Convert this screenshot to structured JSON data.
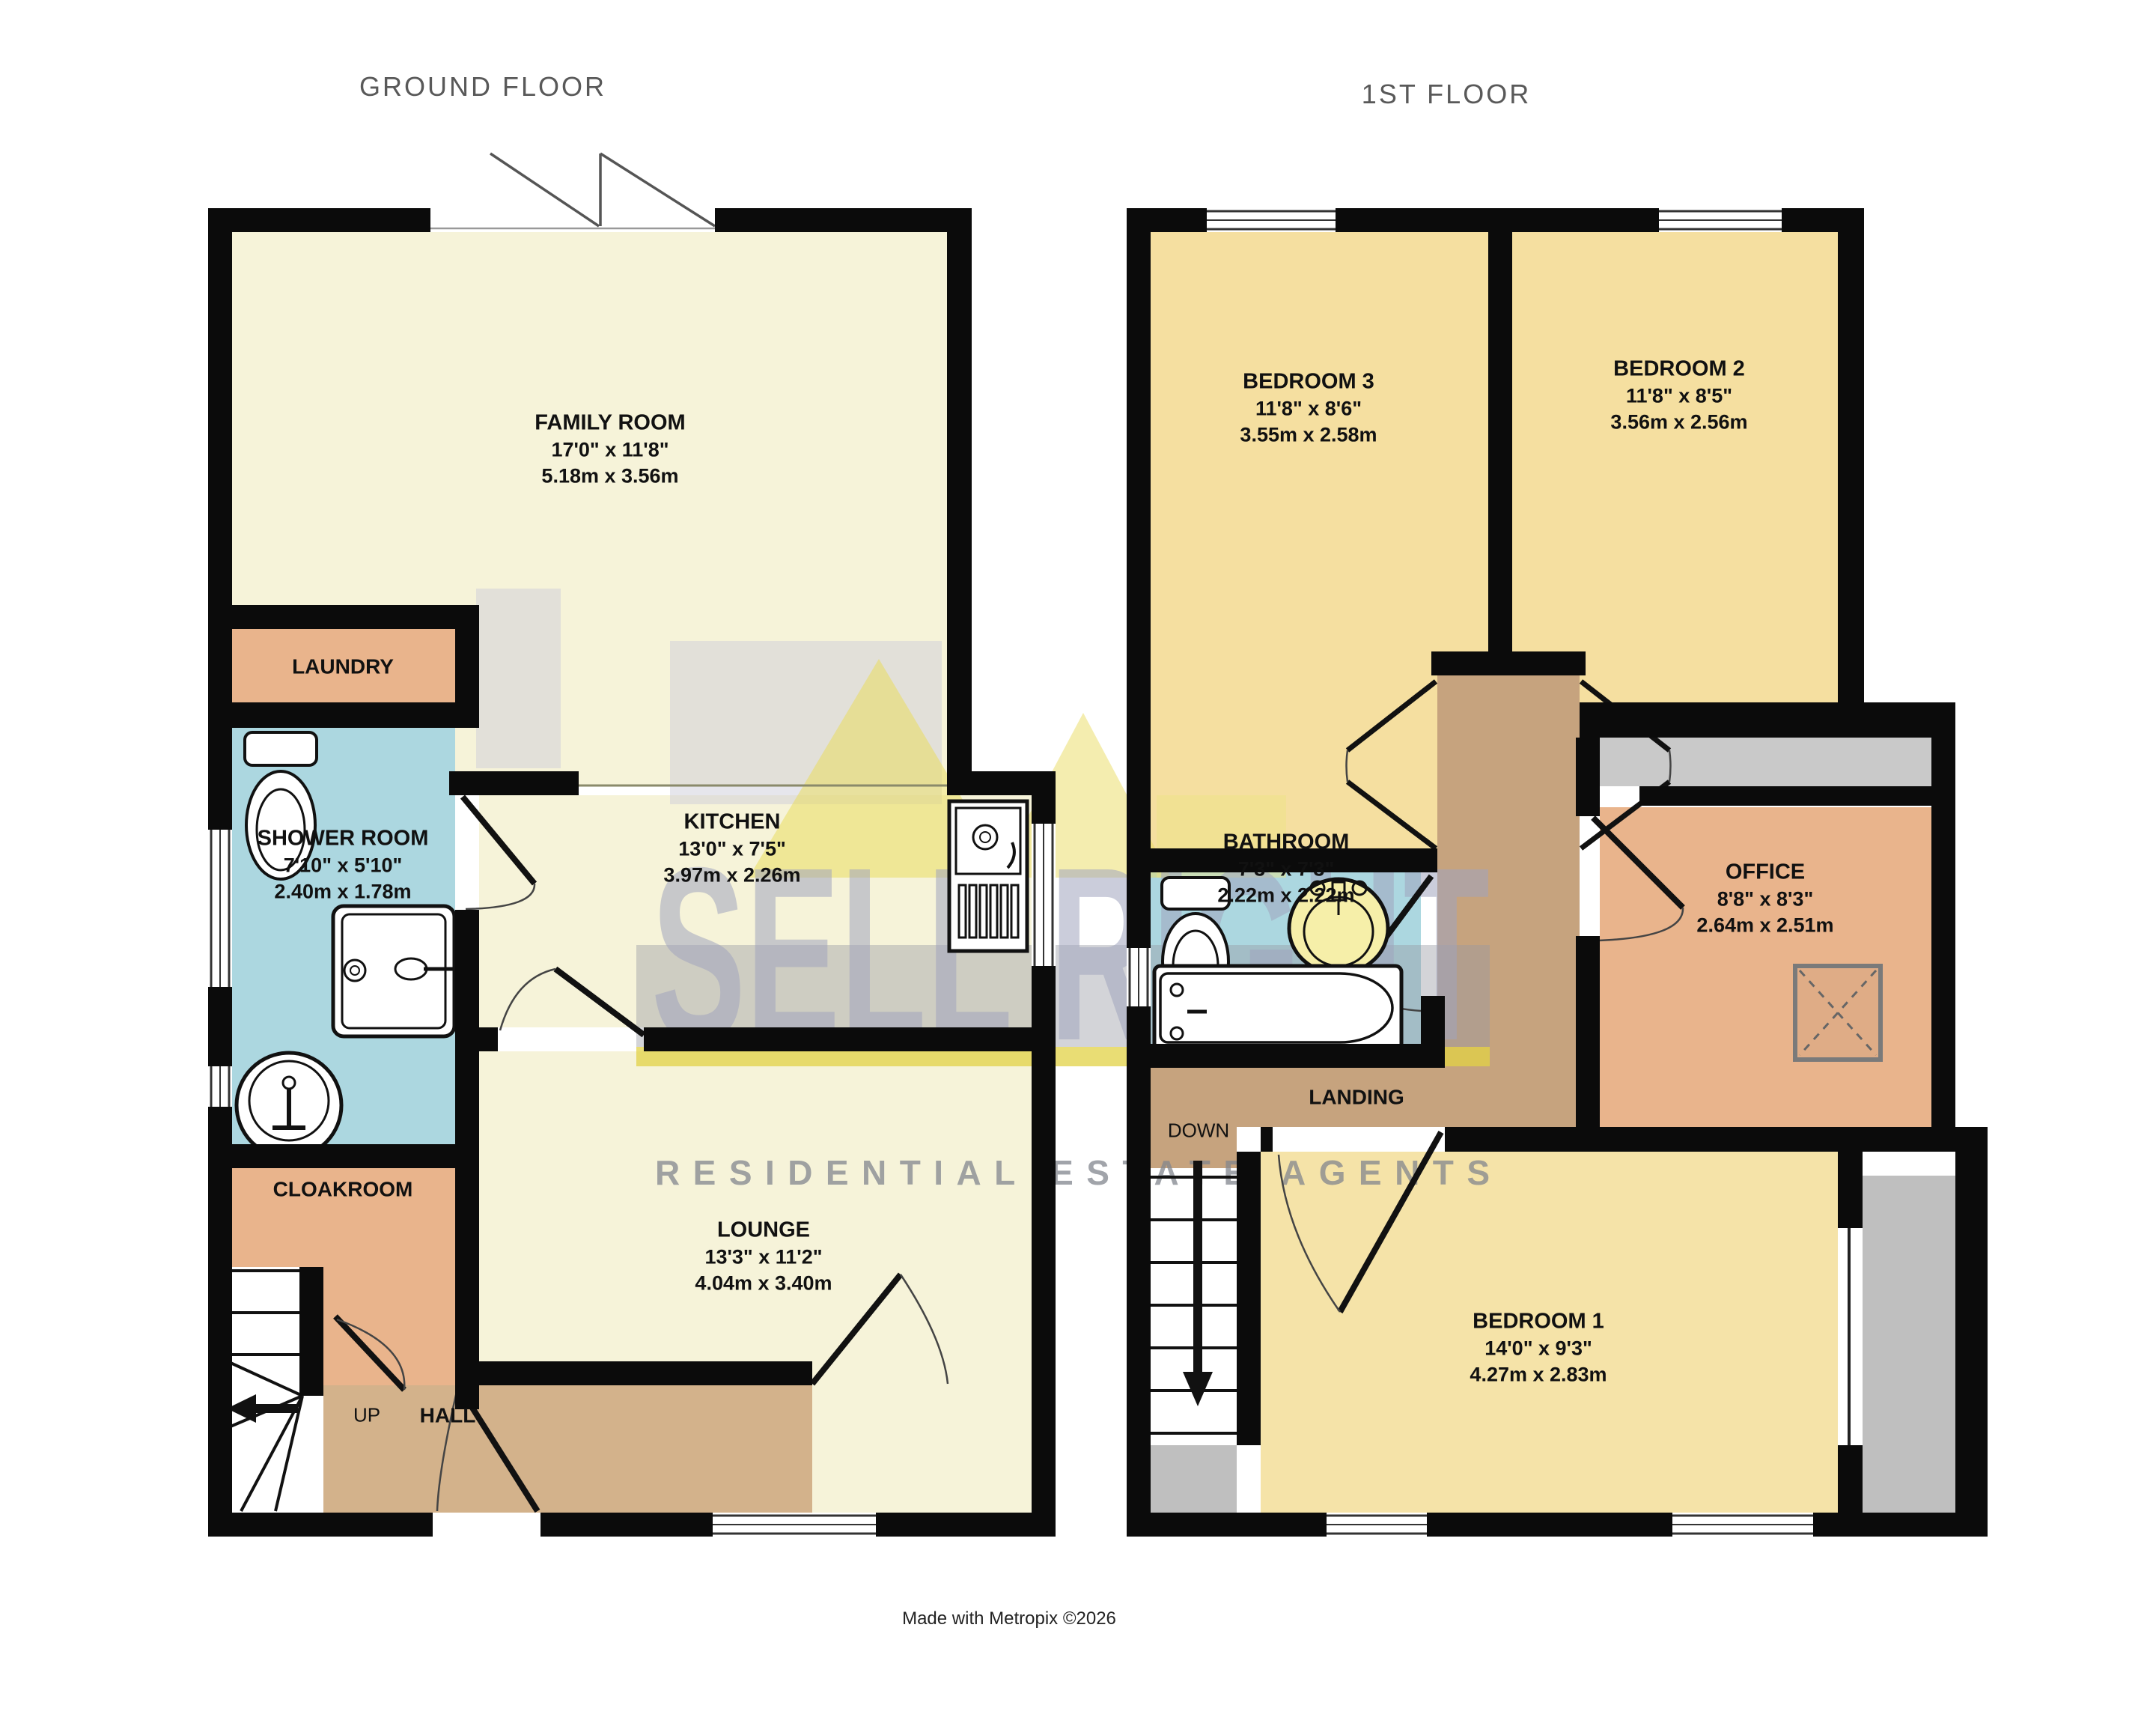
{
  "titles": {
    "ground": "GROUND FLOOR",
    "first": "1ST FLOOR"
  },
  "rooms": {
    "family_room": {
      "name": "FAMILY ROOM",
      "imperial": "17'0\"  x 11'8\"",
      "metric": "5.18m  x 3.56m"
    },
    "laundry": {
      "name": "LAUNDRY"
    },
    "shower_room": {
      "name": "SHOWER ROOM",
      "imperial": "7'10\"  x 5'10\"",
      "metric": "2.40m  x 1.78m"
    },
    "cloakroom": {
      "name": "CLOAKROOM"
    },
    "kitchen": {
      "name": "KITCHEN",
      "imperial": "13'0\"  x 7'5\"",
      "metric": "3.97m  x 2.26m"
    },
    "lounge": {
      "name": "LOUNGE",
      "imperial": "13'3\"  x 11'2\"",
      "metric": "4.04m  x 3.40m"
    },
    "hall": {
      "name": "HALL"
    },
    "bedroom3": {
      "name": "BEDROOM 3",
      "imperial": "11'8\"  x 8'6\"",
      "metric": "3.55m  x 2.58m"
    },
    "bedroom2": {
      "name": "BEDROOM 2",
      "imperial": "11'8\"  x 8'5\"",
      "metric": "3.56m  x 2.56m"
    },
    "bathroom": {
      "name": "BATHROOM",
      "imperial": "7'3\"  x 7'3\"",
      "metric": "2.22m  x 2.22m"
    },
    "office": {
      "name": "OFFICE",
      "imperial": "8'8\"  x 8'3\"",
      "metric": "2.64m  x 2.51m"
    },
    "bedroom1": {
      "name": "BEDROOM 1",
      "imperial": "14'0\"  x 9'3\"",
      "metric": "4.27m  x 2.83m"
    },
    "landing": {
      "name": "LANDING"
    }
  },
  "stairs": {
    "up": "UP",
    "down": "DOWN"
  },
  "watermark": {
    "brand": "SELL RIGHT",
    "tagline": "RESIDENTIAL ESTATE AGENTS"
  },
  "footer": "Made with Metropix ©2026",
  "colors": {
    "wall": "#0b0b0b",
    "cream_room": "#F6F3D9",
    "bedroom_gold": "#F5DFA0",
    "tan_room": "#E9B48C",
    "hall_tan": "#D3B28B",
    "landing_tan": "#C6A37E",
    "bathroom_blue": "#ACD7E0",
    "storage_gray": "#C9C9C9",
    "eaves_gray": "#BFBFBF",
    "watermark_gray": "#9AA0A8",
    "watermark_letters": "#A0A4BE",
    "watermark_yellow": "#E8D95A",
    "title_gray": "#595959"
  }
}
